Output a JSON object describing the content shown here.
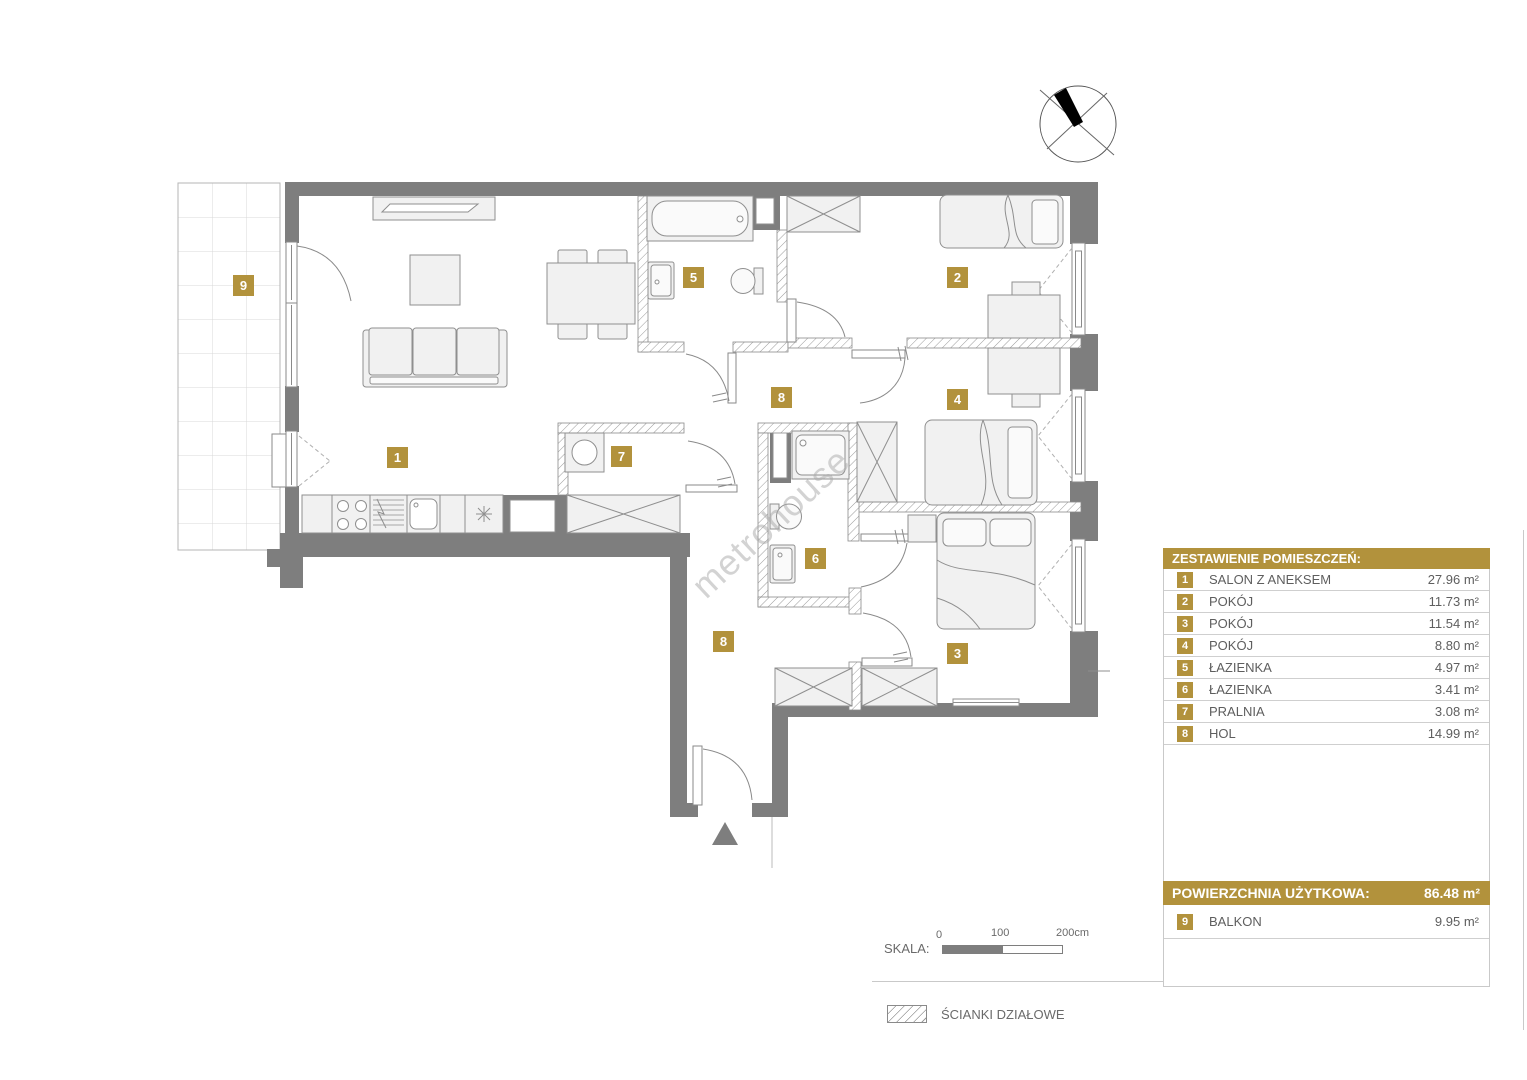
{
  "legend": {
    "header": "ZESTAWIENIE POMIESZCZEŃ:",
    "rows": [
      {
        "num": "1",
        "name": "SALON Z ANEKSEM",
        "area": "27.96 m²"
      },
      {
        "num": "2",
        "name": "POKÓJ",
        "area": "11.73 m²"
      },
      {
        "num": "3",
        "name": "POKÓJ",
        "area": "11.54 m²"
      },
      {
        "num": "4",
        "name": "POKÓJ",
        "area": "8.80 m²"
      },
      {
        "num": "5",
        "name": "ŁAZIENKA",
        "area": "4.97 m²"
      },
      {
        "num": "6",
        "name": "ŁAZIENKA",
        "area": "3.41 m²"
      },
      {
        "num": "7",
        "name": "PRALNIA",
        "area": "3.08 m²"
      },
      {
        "num": "8",
        "name": "HOL",
        "area": "14.99 m²"
      }
    ],
    "total_label": "POWIERZCHNIA UŻYTKOWA:",
    "total_value": "86.48 m²",
    "extra_row": {
      "num": "9",
      "name": "BALKON",
      "area": "9.95 m²"
    }
  },
  "scale": {
    "label": "SKALA:",
    "tick0": "0",
    "tick100": "100",
    "tick200": "200cm"
  },
  "partition_legend": {
    "label": "ŚCIANKI DZIAŁOWE"
  },
  "watermark": "metrohouse",
  "room_badges": [
    {
      "num": "1",
      "x": 387,
      "y": 447
    },
    {
      "num": "2",
      "x": 947,
      "y": 267
    },
    {
      "num": "3",
      "x": 947,
      "y": 643
    },
    {
      "num": "4",
      "x": 947,
      "y": 389
    },
    {
      "num": "5",
      "x": 683,
      "y": 267
    },
    {
      "num": "6",
      "x": 805,
      "y": 548
    },
    {
      "num": "7",
      "x": 611,
      "y": 446
    },
    {
      "num": "8",
      "x": 771,
      "y": 387
    },
    {
      "num": "8",
      "x": 713,
      "y": 631
    },
    {
      "num": "9",
      "x": 233,
      "y": 275
    }
  ],
  "colors": {
    "accent": "#b2923c",
    "wall": "#7e7e7e"
  }
}
